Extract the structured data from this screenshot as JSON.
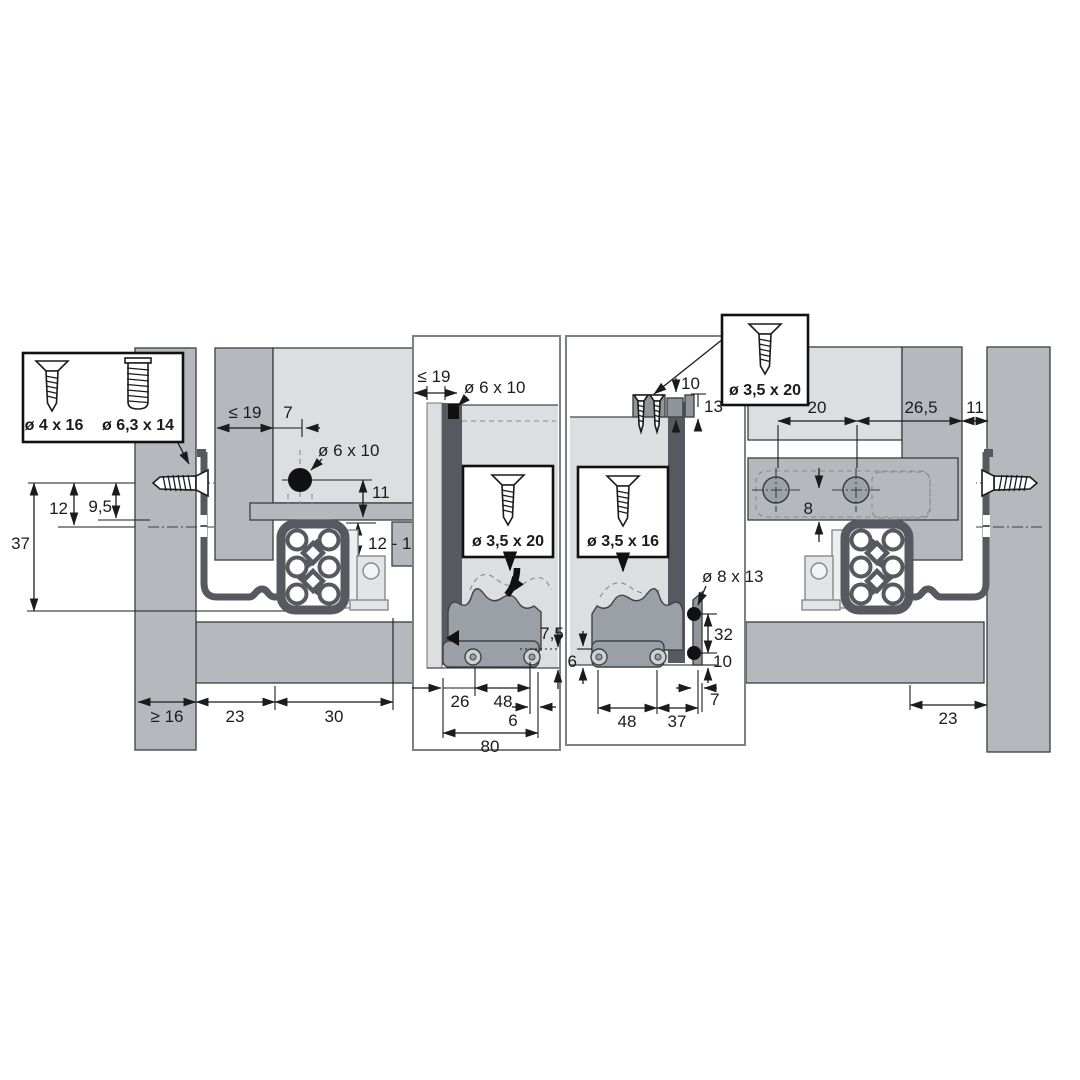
{
  "colors": {
    "background": "#ffffff",
    "panel_gray": "#b5b9be",
    "light_gray": "#dcdee1",
    "profile_dark": "#565a60",
    "fitting_gray": "#90959b",
    "line_black": "#1b1b1b"
  },
  "screw_boxes": {
    "wall": {
      "label_1": "ø 4 x 16",
      "label_2": "ø 6,3 x 14"
    },
    "front": {
      "label": "ø 3,5 x 20"
    },
    "back": {
      "label": "ø 3,5 x 16"
    },
    "top": {
      "label": "ø 3,5 x 20"
    }
  },
  "sections": {
    "left": {
      "dims": {
        "panel_max": "≤ 19",
        "offset": "7",
        "dowel": "ø 6 x 10",
        "below_top": "11",
        "range": "12 - 13",
        "screw_center": "12",
        "hook_center": "9,5",
        "total": "37",
        "wall_min": "≥ 16",
        "clearance": "23",
        "depth": "30"
      }
    },
    "middle_left": {
      "dims": {
        "panel_max": "≤ 19",
        "dowel": "ø 6 x 10",
        "recess": "7,5",
        "front_inset": "26",
        "screw_span": "48",
        "edge": "6",
        "total": "80"
      }
    },
    "middle_right": {
      "dims": {
        "top_height": "10",
        "top_depth": "13",
        "dowel": "ø 8 x 13",
        "hole_span": "32",
        "bottom_offset": "10",
        "recess": "6",
        "screw_span": "48",
        "edge": "37",
        "hook_width": "7"
      }
    },
    "right": {
      "dims": {
        "front": "20",
        "mid": "26,5",
        "wall_offset": "11",
        "below_center": "8",
        "clearance": "23"
      }
    }
  }
}
